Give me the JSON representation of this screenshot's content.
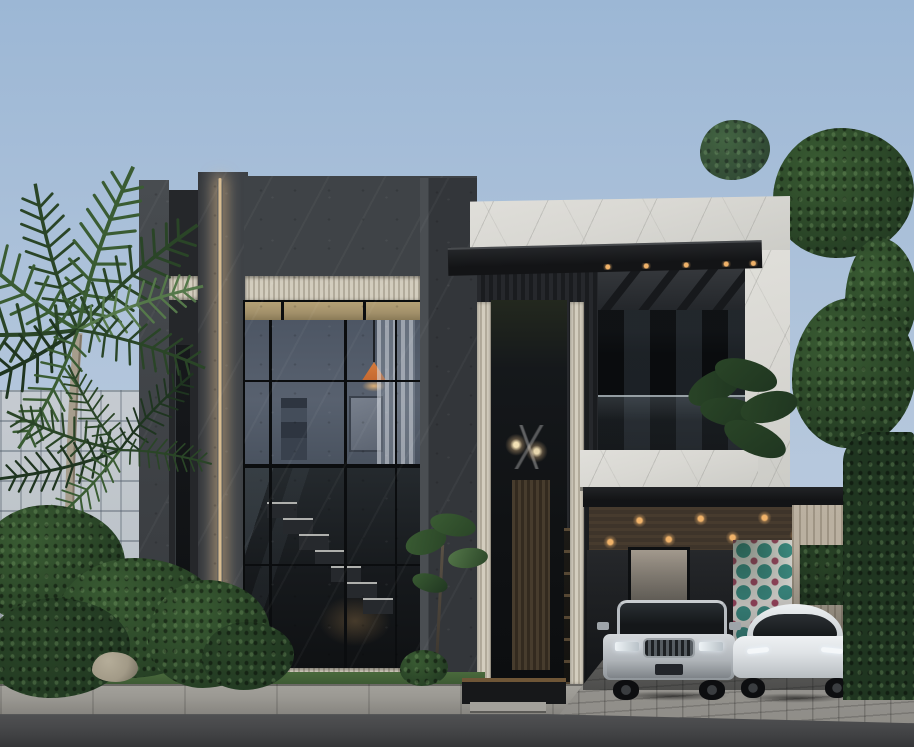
{
  "scene": {
    "description": "Photorealistic exterior rendering of a modern two-storey luxury house at dusk-lit daytime: dark charcoal stone volumes with a warm vertical LED strip, beige fluted accent bands, champagne window transoms, a white marble upper volume with black steel canopy, double-height glazing revealing a staircase and a lit lounge with an orange pendant lamp, a carport with wood-slat lit ceiling sheltering a silver SUV and a white electric crossover, a teal-and-magenta patterned tile feature wall, tropical palms and dense planting at left, trees and a hedge at right, concrete sidewalk, paver driveway apron and asphalt road in the foreground",
    "objects": [
      {
        "name": "sky",
        "label": "clear blue-grey sky"
      },
      {
        "name": "background-building",
        "label": "glass building behind palms"
      },
      {
        "name": "palm-tree",
        "label": "tall palm with feathered fronds"
      },
      {
        "name": "dark-volume",
        "label": "charcoal stone facade block"
      },
      {
        "name": "led-strip",
        "label": "warm vertical LED lighting strip"
      },
      {
        "name": "upper-window",
        "label": "lit lounge window with orange pendant lamp"
      },
      {
        "name": "lower-window",
        "label": "double-height glazing with staircase"
      },
      {
        "name": "entrance-tower",
        "label": "recessed entry with chandelier and wood door"
      },
      {
        "name": "white-volume",
        "label": "white marble upper volume"
      },
      {
        "name": "black-canopy",
        "label": "black steel canopy with downlights"
      },
      {
        "name": "balcony",
        "label": "marble balcony with glass balustrade"
      },
      {
        "name": "carport",
        "label": "carport with slatted lit ceiling"
      },
      {
        "name": "tile-wall",
        "label": "teal and magenta patterned tile wall"
      },
      {
        "name": "suv",
        "label": "silver luxury SUV"
      },
      {
        "name": "ev-crossover",
        "label": "white electric crossover"
      },
      {
        "name": "hedge",
        "label": "green hedge"
      },
      {
        "name": "road",
        "label": "asphalt road and paver driveway"
      }
    ]
  },
  "palette": {
    "sky_top": "#9cb7d5",
    "sky_mid": "#b0c4db",
    "sky_bottom": "#c3d0e1",
    "bg_building": "#c7ccd1",
    "charcoal": "#3f4347",
    "flute_light": "#d3cdbe",
    "flute_dark": "#b2ab9b",
    "champagne": "#a2906a",
    "led_core": "#f4d29c",
    "marble": "#d9d8d3",
    "fascia": "#131416",
    "glass": "#16191c",
    "interior_wall": "#58616f",
    "lamp_orange": "#c4662f",
    "wood_ceiling": "#3e342a",
    "wood_light": "#b4aa9a",
    "light_dot": "#f0b269",
    "tile_teal": "#3f948a",
    "tile_white": "#eae8e2",
    "tile_magenta": "#a84a66",
    "green_deep": "#1f3520",
    "green_dark": "#2a4527",
    "green_mid": "#3a5c33",
    "green_light": "#55784a",
    "trunk": "#a69d8c",
    "grass": "#3a5531",
    "sidewalk": "#9b9993",
    "paver": "#8f8d88",
    "road": "#47484a",
    "road_dark": "#353638",
    "suv_silver": "#b7bcc1",
    "tesla_white": "#dfe3e6",
    "car_glass": "#141719",
    "rock": "#a29a87",
    "step_light": "#a3a19b",
    "red_accent": "#6e2130"
  }
}
